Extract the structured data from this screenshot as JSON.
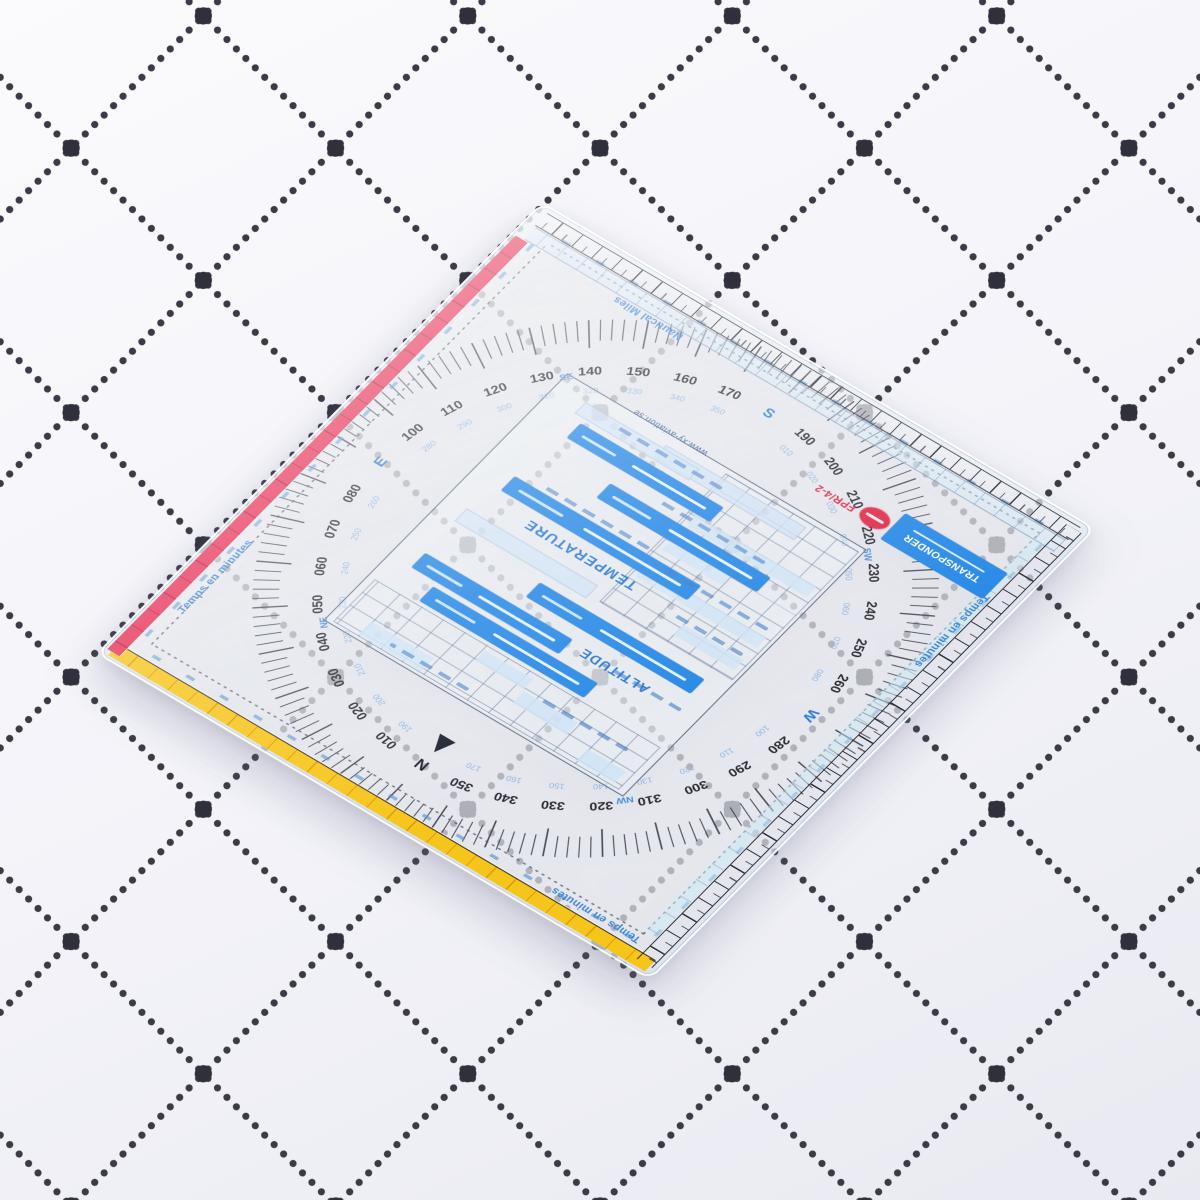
{
  "plotter": {
    "edge_labels": {
      "nautical_miles": "Nautical Miles",
      "temps_top": "Temps en minutes",
      "temps_left": "Temps en minutes",
      "temps_right": "Temps en minutes"
    },
    "panel": {
      "temperature_title": "TEMPERATURE",
      "altitude_title": "ALTITUDE",
      "transponder_title": "TRANSPONDER",
      "model": "FPR/4-2",
      "url": "www.xy-aviation.se"
    },
    "compass": {
      "headings": [
        {
          "deg": 10,
          "label": "010",
          "recip": "190"
        },
        {
          "deg": 20,
          "label": "020",
          "recip": "200"
        },
        {
          "deg": 30,
          "label": "030",
          "recip": "210"
        },
        {
          "deg": 40,
          "label": "040",
          "recip": "220"
        },
        {
          "deg": 50,
          "label": "050",
          "recip": "230"
        },
        {
          "deg": 60,
          "label": "060",
          "recip": "240"
        },
        {
          "deg": 70,
          "label": "070",
          "recip": "250"
        },
        {
          "deg": 80,
          "label": "080",
          "recip": "260"
        },
        {
          "deg": 100,
          "label": "100",
          "recip": "280"
        },
        {
          "deg": 110,
          "label": "110",
          "recip": "290"
        },
        {
          "deg": 120,
          "label": "120",
          "recip": "300"
        },
        {
          "deg": 130,
          "label": "130",
          "recip": "310"
        },
        {
          "deg": 140,
          "label": "140",
          "recip": "320"
        },
        {
          "deg": 150,
          "label": "150",
          "recip": "330"
        },
        {
          "deg": 160,
          "label": "160",
          "recip": "340"
        },
        {
          "deg": 170,
          "label": "170",
          "recip": "350"
        },
        {
          "deg": 190,
          "label": "190",
          "recip": "010"
        },
        {
          "deg": 200,
          "label": "200",
          "recip": "020"
        },
        {
          "deg": 210,
          "label": "210",
          "recip": "030"
        },
        {
          "deg": 220,
          "label": "220",
          "recip": "040"
        },
        {
          "deg": 230,
          "label": "230",
          "recip": "050"
        },
        {
          "deg": 240,
          "label": "240",
          "recip": "060"
        },
        {
          "deg": 250,
          "label": "250",
          "recip": "070"
        },
        {
          "deg": 260,
          "label": "260",
          "recip": "080"
        },
        {
          "deg": 280,
          "label": "280",
          "recip": "100"
        },
        {
          "deg": 290,
          "label": "290",
          "recip": "110"
        },
        {
          "deg": 300,
          "label": "300",
          "recip": "120"
        },
        {
          "deg": 310,
          "label": "310",
          "recip": "130"
        },
        {
          "deg": 320,
          "label": "320",
          "recip": "140"
        },
        {
          "deg": 330,
          "label": "330",
          "recip": "150"
        },
        {
          "deg": 340,
          "label": "340",
          "recip": "160"
        },
        {
          "deg": 350,
          "label": "350",
          "recip": "170"
        }
      ],
      "cardinals": [
        {
          "deg": 360,
          "label": "N"
        },
        {
          "deg": 90,
          "label": "E"
        },
        {
          "deg": 180,
          "label": "S"
        },
        {
          "deg": 270,
          "label": "W"
        }
      ],
      "intercardinals": [
        {
          "deg": 45,
          "label": "NE"
        },
        {
          "deg": 135,
          "label": "SE"
        },
        {
          "deg": 225,
          "label": "SW"
        },
        {
          "deg": 315,
          "label": "NW"
        }
      ]
    }
  },
  "colors": {
    "paper": "#f3f3f9",
    "paper_hi": "#fbfbfd",
    "paper_lo": "#e9e9f1",
    "dot": "#3b3b47",
    "dot_big": "#30303c",
    "tick": "#4b4b57",
    "number": "#2b2b34",
    "recip": "#8fb6e0",
    "cardinal": "#2f7fd6",
    "band": "#2688e6",
    "band_light": "#cfe3f6",
    "title": "#1a6fd4",
    "yellow": "#f6c51b",
    "yellow_dark": "#df9a00",
    "red": "#e62a50",
    "red_dark": "#b5123c",
    "logo": "#e02844",
    "outline": "#5a6880",
    "micro": "#3c78c3",
    "url": "#2b4f9e"
  }
}
